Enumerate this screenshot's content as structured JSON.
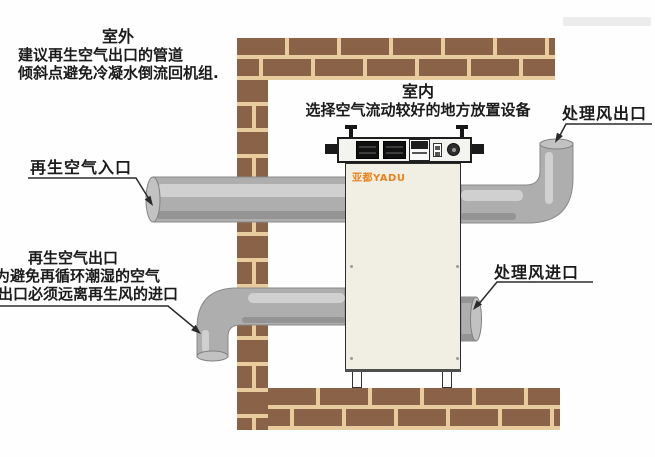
{
  "diagram": {
    "outdoor_note": {
      "title": "室外",
      "lines": [
        "建议再生空气出口的管道",
        "倾斜点避免冷凝水倒流回机组."
      ]
    },
    "indoor_note": {
      "title": "室内",
      "subtitle": "选择空气流动较好的地方放置设备"
    },
    "labels": {
      "regen_air_inlet": "再生空气入口",
      "regen_air_outlet_title": "再生空气出口",
      "regen_air_outlet_line1": "为避免再循环潮湿的空气",
      "regen_air_outlet_line2": "出口必须远离再生风的进口",
      "treated_air_outlet": "处理风出口",
      "treated_air_inlet": "处理风进口"
    },
    "machine": {
      "brand_logo": "亚都YADU"
    },
    "colors": {
      "brick": "#8a6248",
      "mortar": "#e9cc9e",
      "pipe": "#aeaeae",
      "pipe_highlight": "#d4d4d4",
      "pipe_shadow": "#8f8f8f",
      "machine_body": "#f1eee3",
      "panel_bg": "#f3f3ef",
      "logo": "#e8821e",
      "line": "#2a2a2a",
      "text": "#1b1b1b"
    }
  }
}
